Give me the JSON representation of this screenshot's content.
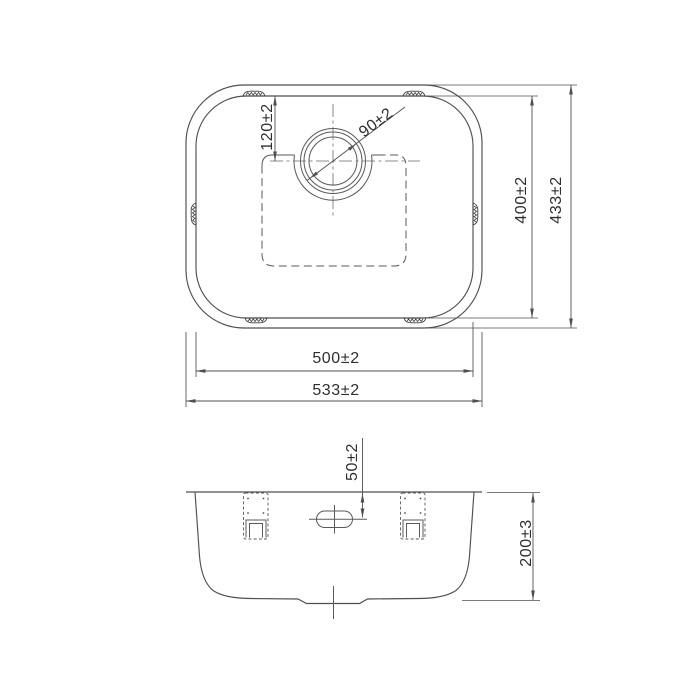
{
  "drawing": {
    "background": "#ffffff",
    "line_color": "#4f4f52",
    "text_color": "#2f2f31",
    "views": {
      "plan": {
        "title": "sink plan view",
        "dims": {
          "outer_width": "533±2",
          "inner_width": "500±2",
          "outer_height": "433±2",
          "inner_height": "400±2",
          "drain_center_offset": "120±2",
          "drain_diameter": "90±2"
        }
      },
      "section": {
        "title": "sink front section view",
        "dims": {
          "overflow_offset": "50±2",
          "bowl_depth": "200±3"
        }
      }
    }
  }
}
